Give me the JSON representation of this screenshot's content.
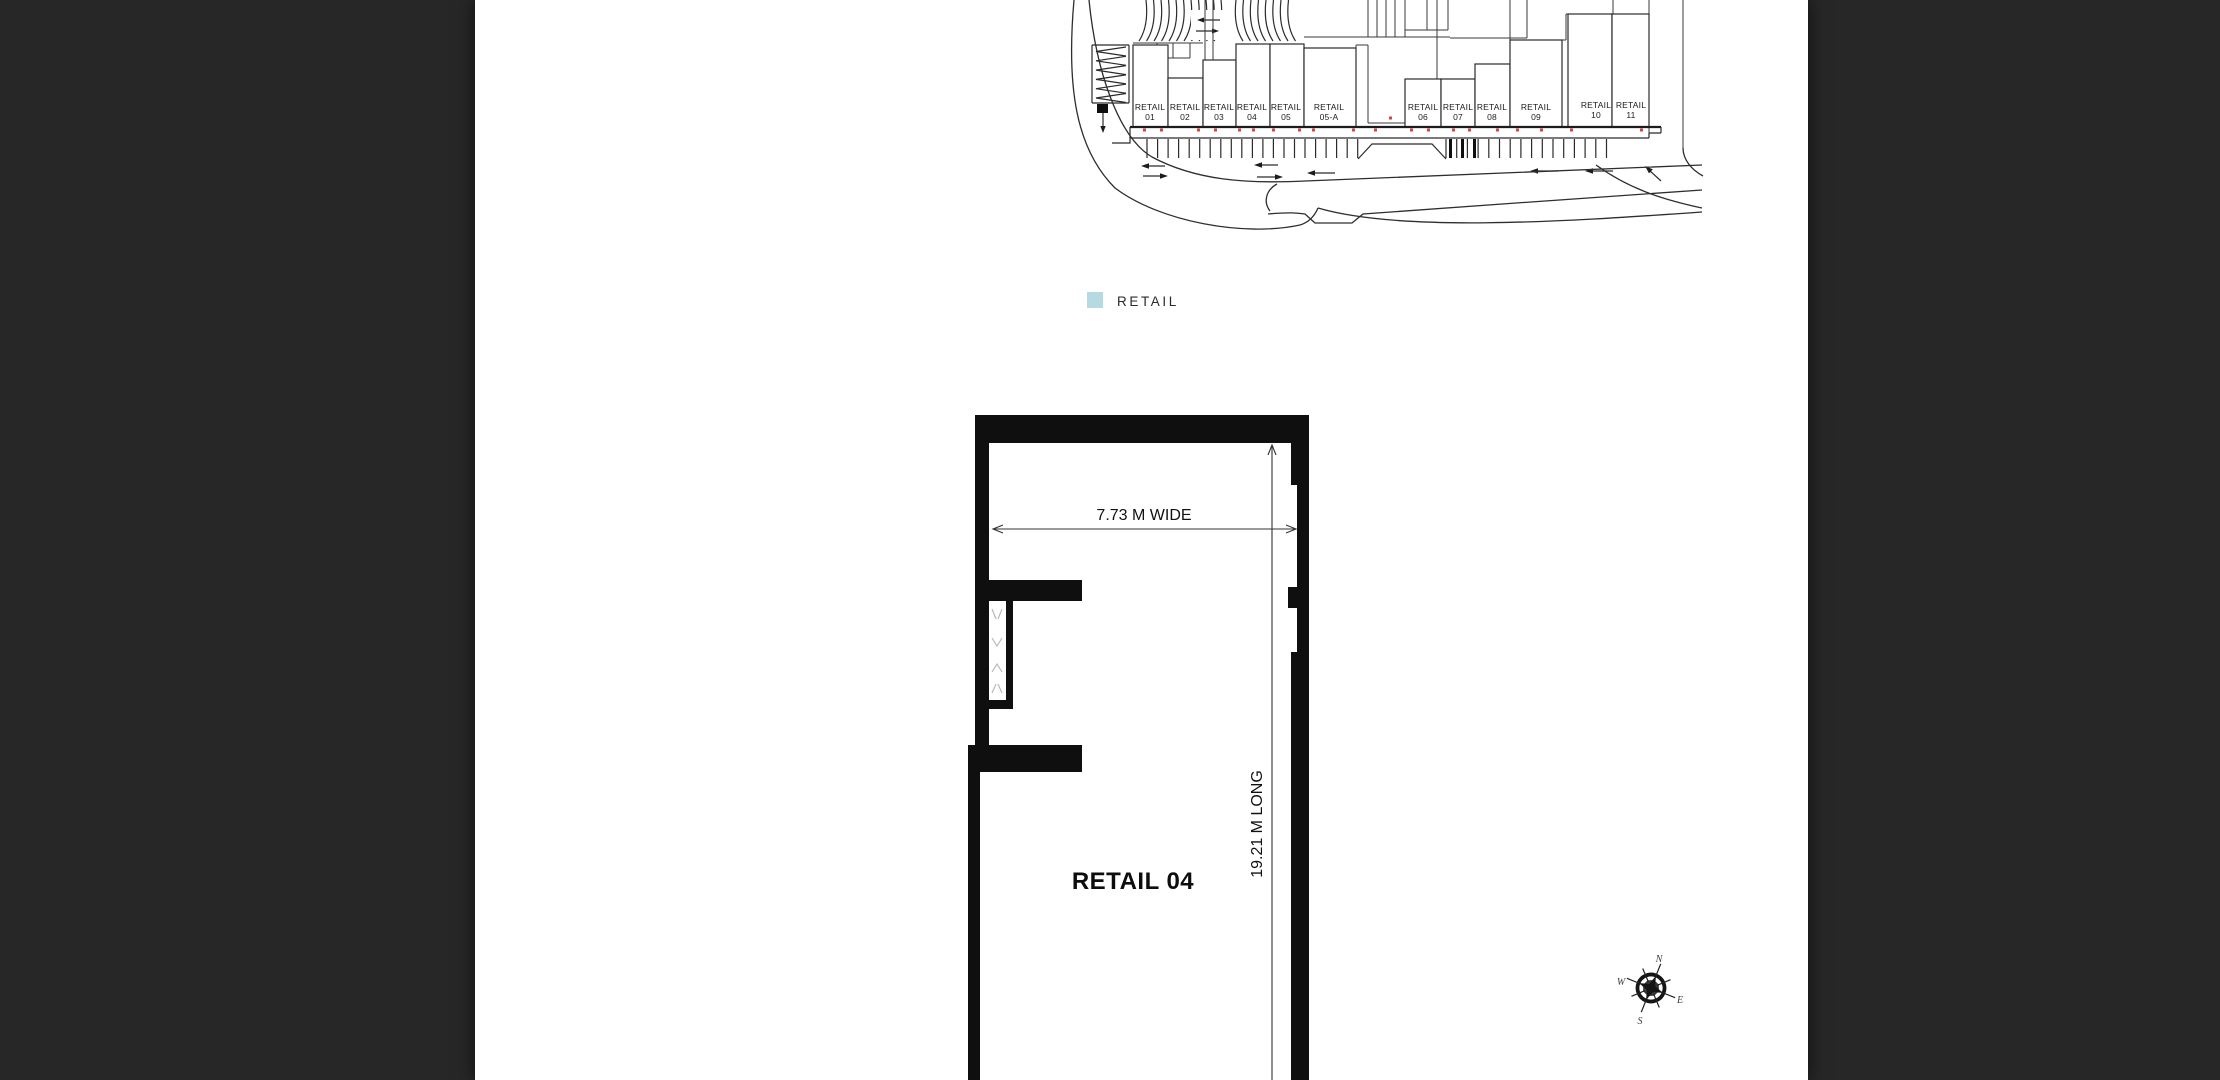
{
  "page": {
    "background": "#272727",
    "paper": "#ffffff"
  },
  "colors": {
    "highlight": "#b5dae2",
    "line": "#2b2b2b",
    "wall": "#0f0f0f",
    "red_dot": "#d9453c"
  },
  "site_plan": {
    "units": [
      {
        "label": "RETAIL",
        "number": "01",
        "highlighted": false
      },
      {
        "label": "RETAIL",
        "number": "02",
        "highlighted": false
      },
      {
        "label": "RETAIL",
        "number": "03",
        "highlighted": false
      },
      {
        "label": "RETAIL",
        "number": "04",
        "highlighted": true
      },
      {
        "label": "RETAIL",
        "number": "05",
        "highlighted": false
      },
      {
        "label": "RETAIL",
        "number": "05-A",
        "highlighted": false
      },
      {
        "label": "RETAIL",
        "number": "06",
        "highlighted": false
      },
      {
        "label": "RETAIL",
        "number": "07",
        "highlighted": false
      },
      {
        "label": "RETAIL",
        "number": "08",
        "highlighted": false
      },
      {
        "label": "RETAIL",
        "number": "09",
        "highlighted": false
      },
      {
        "label": "RETAIL",
        "number": "10",
        "highlighted": false
      },
      {
        "label": "RETAIL",
        "number": "11",
        "highlighted": false
      }
    ]
  },
  "legend": {
    "label": "RETAIL"
  },
  "floor_plan": {
    "name": "RETAIL 04",
    "width_dim": "7.73 M WIDE",
    "length_dim": "19.21 M LONG"
  },
  "compass": {
    "north": "N",
    "east": "E",
    "south": "S",
    "west": "W"
  }
}
